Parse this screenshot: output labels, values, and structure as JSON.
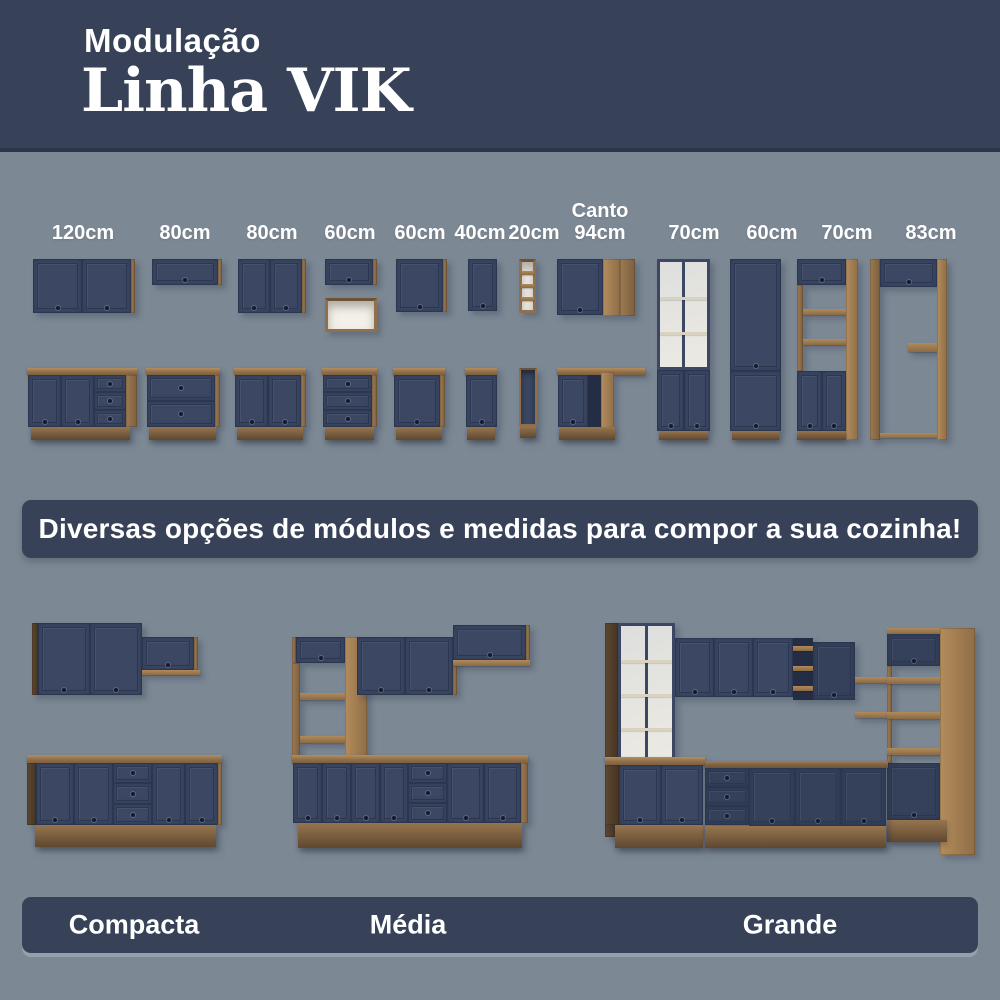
{
  "header": {
    "eyebrow": "Modulação",
    "title": "Linha VIK"
  },
  "modules": {
    "labels": [
      "120cm",
      "80cm",
      "80cm",
      "60cm",
      "60cm",
      "40cm",
      "20cm",
      "Canto\n94cm",
      "70cm",
      "60cm",
      "70cm",
      "83cm"
    ]
  },
  "banner": {
    "text": "Diversas opções de módulos e medidas para compor a sua cozinha!"
  },
  "kitchens": {
    "items": [
      {
        "label": "Compacta"
      },
      {
        "label": "Média"
      },
      {
        "label": "Grande"
      }
    ]
  },
  "colors": {
    "header_bg": "#374258",
    "page_bg": "#7C8894",
    "cabinet_navy": "#3B4763",
    "wood": "#8F6F4C",
    "text": "#FFFFFF"
  }
}
